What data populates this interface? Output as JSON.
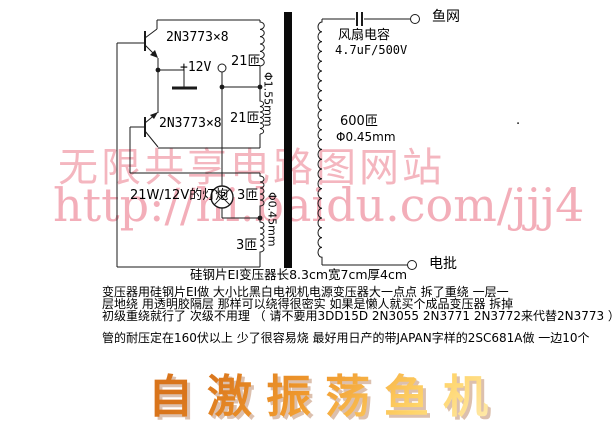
{
  "watermark": {
    "line1": "无限共享电路图网站",
    "line2": "http://hi.baidu.com/jjj4",
    "color": "#f4b6bf"
  },
  "schematic": {
    "transistor_top": "2N3773×8",
    "transistor_bottom": "2N3773×8",
    "supply": "+12V",
    "primary_upper_turns": "21匝",
    "primary_lower_turns": "21匝",
    "primary_wire": "Φ1.55mm",
    "feedback_upper_turns": "3匝",
    "feedback_lower_turns": "3匝",
    "feedback_wire": "Φ0.45mm",
    "lamp": "21W/12V的灯炮",
    "cap_name": "风扇电容",
    "cap_value": "4.7uF/500V",
    "secondary_turns": "600匝",
    "secondary_wire": "Φ0.45mm",
    "terminal_top": "鱼网",
    "terminal_bottom": "电批",
    "caption": "硅钢片EI变压器长8.3cm宽7cm厚4cm",
    "stray_dot": "."
  },
  "notes": {
    "line1": "变压器用硅钢片EI做 大小比黑白电视机电源变压器大一点点 拆了重绕 一层一",
    "line2": "层地绕 用透明胶隔层 那样可以绕得很密实 如果是懒人就买个成品变压器 拆掉",
    "line3": "初级重绕就行了 次级不用理 （ 请不要用3DD15D 2N3055 2N3771 2N3772来代替2N3773 ）",
    "line4": "管的耐压定在160伏以上 少了很容易烧 最好用日产的带JAPAN字样的2SC681A做 一边10个"
  },
  "title": {
    "text": "自激振荡鱼机",
    "color_main": "#ee8a1e",
    "color_highlight": "#ffd469",
    "shadow_color": "#dcc0ae"
  }
}
